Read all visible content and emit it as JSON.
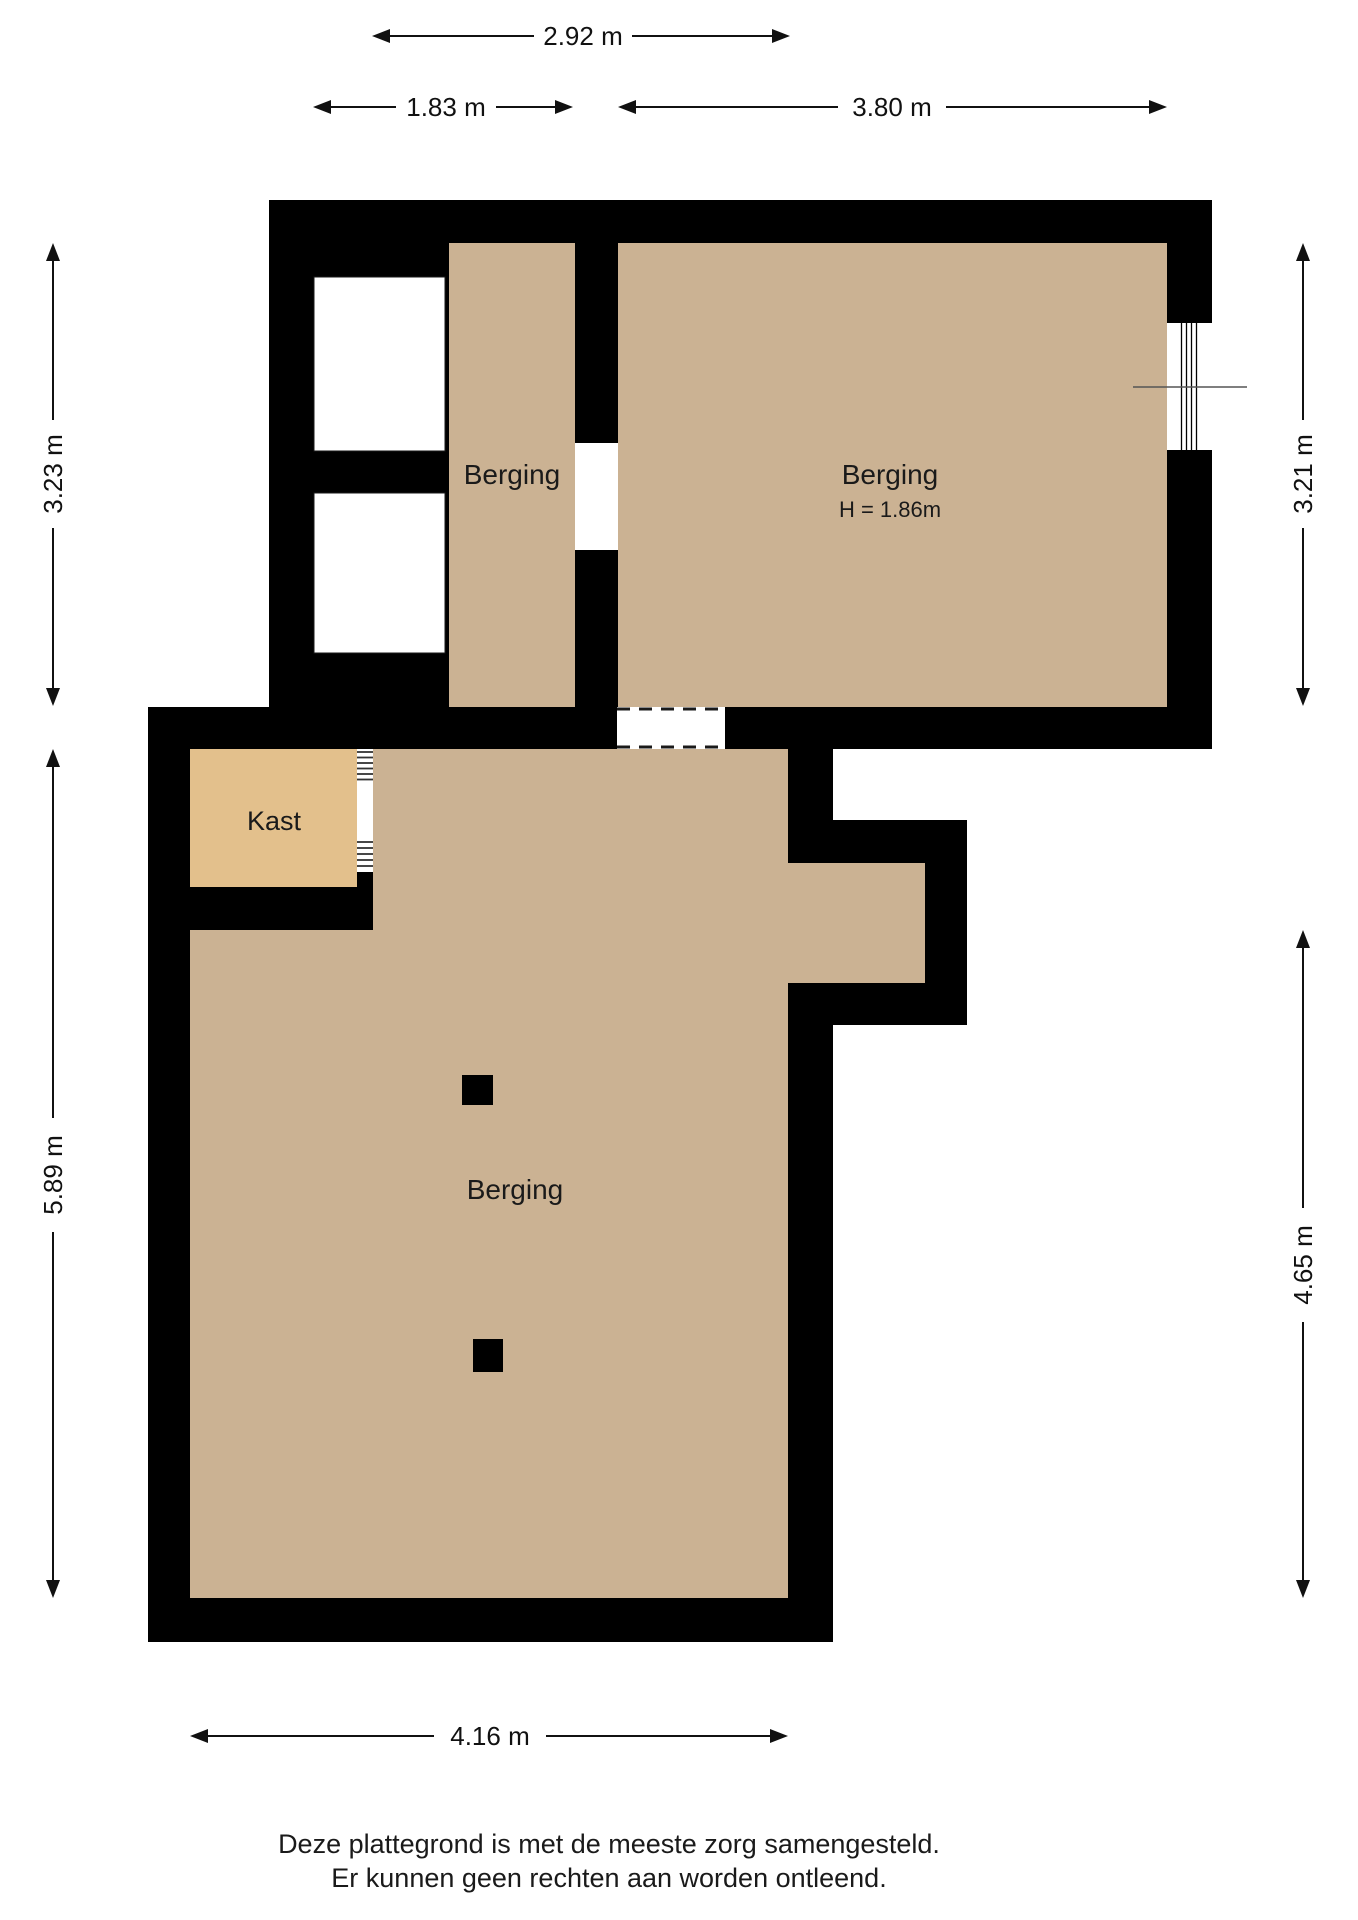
{
  "rooms": {
    "upper_left_label": "Berging",
    "upper_right_label": "Berging",
    "upper_right_height": "H = 1.86m",
    "kast_label": "Kast",
    "lower_label": "Berging"
  },
  "dimensions": {
    "top_width": "2.92 m",
    "top_left_width": "1.83 m",
    "top_right_width": "3.80 m",
    "upper_left_height": "3.23 m",
    "upper_right_height": "3.21 m",
    "lower_left_height": "5.89 m",
    "lower_right_height": "4.65 m",
    "bottom_width": "4.16 m"
  },
  "footer": {
    "line1": "Deze plattegrond is met de meeste zorg samengesteld.",
    "line2": "Er kunnen geen rechten aan worden ontleend."
  },
  "colors": {
    "floor": "#cbb293",
    "kast_floor": "#e3c08c",
    "wall": "#000000",
    "text": "#1a1a1a",
    "dim": "#111111"
  }
}
